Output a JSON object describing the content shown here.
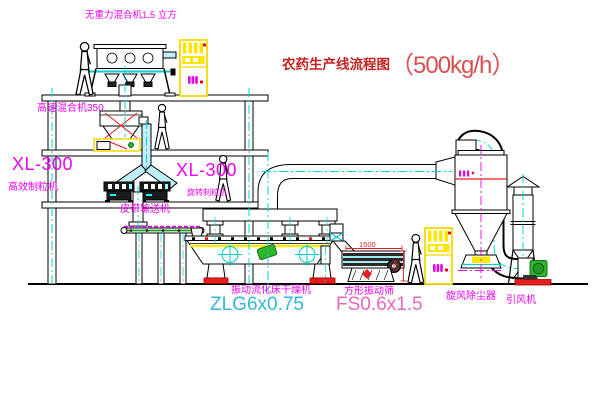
{
  "title": {
    "text": "农药生产线流程图",
    "capacity": "（500kg/h）"
  },
  "equipment_labels": {
    "gravity_mixer": "无重力混合机1.5 立方",
    "high_speed_mixer": "高速混合机350",
    "granulator_left_model": "XL-300",
    "granulator_left_name": "高效制粒机",
    "granulator_right_model": "XL-300",
    "granulator_right_name": "旋转制粒机",
    "belt_conveyor": "皮带输送机",
    "fluid_bed_dryer": "振动流化床干燥机",
    "fluid_bed_dryer_model": "ZLG6x0.75",
    "vibrating_screen": "方形振动筛",
    "vibrating_screen_model": "FS0.6x1.5",
    "cyclone": "旋风除尘器",
    "induced_draft_fan": "引风机"
  },
  "dimensions": {
    "screen_length": "1500",
    "screen_height": "340"
  },
  "colors": {
    "label_magenta": "#ee00ee",
    "title_red": "#c22222",
    "capacity_red": "#d85050",
    "dryer_model_cyan": "#35b8d8",
    "screen_model_pink": "#e868b8",
    "centerline_cyan": "#00d4d4",
    "machine_yellow": "#ffe600",
    "accent_red": "#e02020",
    "accent_green": "#2eb52e"
  }
}
